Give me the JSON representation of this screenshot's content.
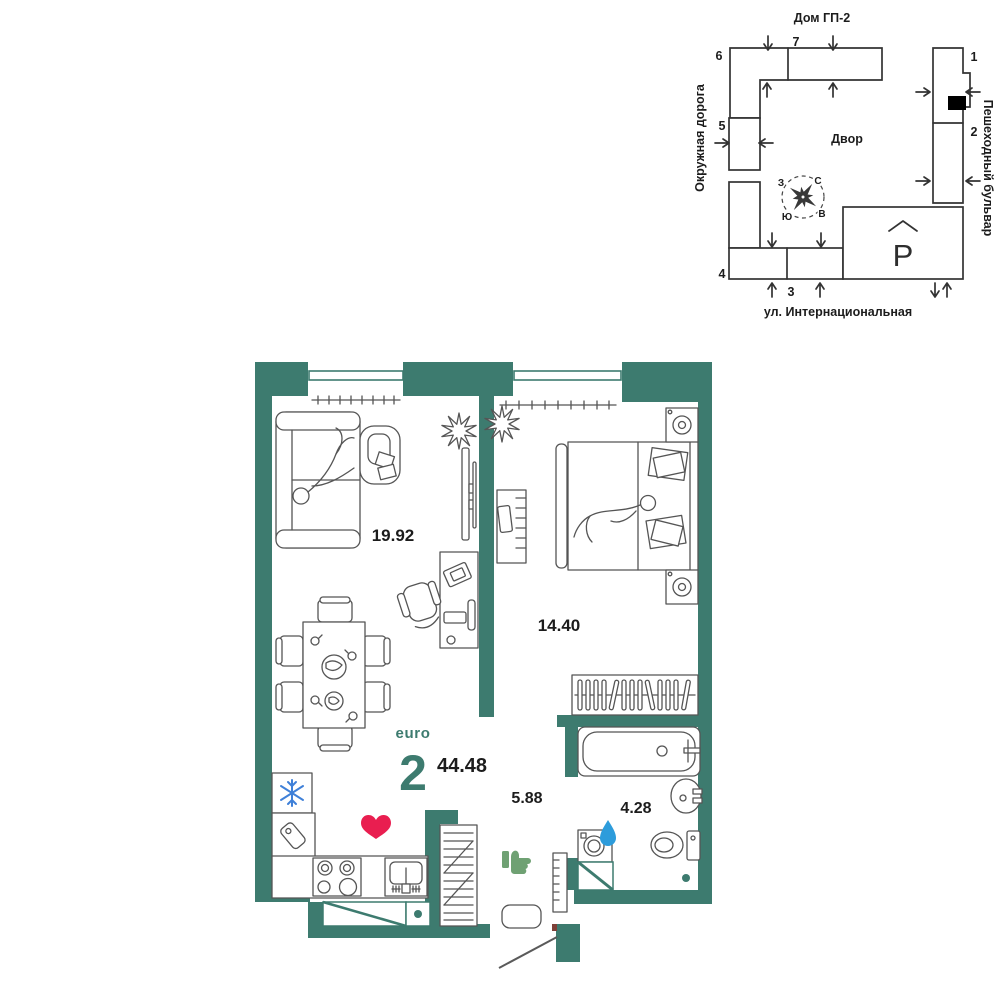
{
  "apartment": {
    "type_label": "euro",
    "rooms_count": "2",
    "total_area": "44.48",
    "rooms": [
      {
        "name": "living-kitchen",
        "area": "19.92"
      },
      {
        "name": "bedroom",
        "area": "14.40"
      },
      {
        "name": "hallway",
        "area": "5.88"
      },
      {
        "name": "bathroom",
        "area": "4.28"
      }
    ]
  },
  "site_plan": {
    "title": "Дом ГП-2",
    "courtyard_label": "Двор",
    "parking_label": "Р",
    "streets": {
      "left": "Окружная дорога",
      "right": "Пешеходный бульвар",
      "bottom": "ул. Интернациональная"
    },
    "sections": [
      "1",
      "2",
      "3",
      "4",
      "5",
      "6",
      "7"
    ],
    "compass": {
      "north": "С",
      "south": "Ю",
      "west": "З",
      "east": "В"
    }
  },
  "icons": {
    "fridge": "snowflake-icon",
    "kitchen": "heart-icon",
    "laundry": "water-drop-icon",
    "hallway": "thumbs-up-icon"
  },
  "colors": {
    "wall": "#3D7B6F",
    "heart": "#E91E50",
    "water_drop": "#2D9CDB",
    "thumbs_up": "#6FA173",
    "snowflake": "#3F80D8"
  }
}
